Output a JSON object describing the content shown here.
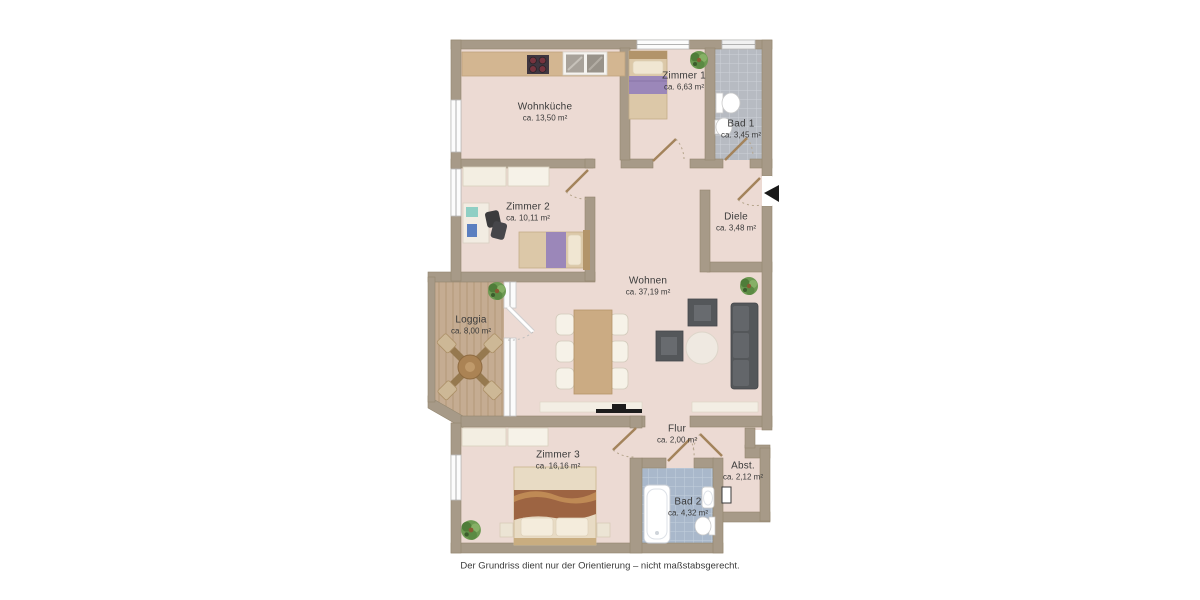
{
  "page": {
    "background": "#ffffff",
    "caption": "Der Grundriss dient nur der Orientierung – nicht maßstabsgerecht."
  },
  "rooms": [
    {
      "id": "wohnkueche",
      "name": "Wohnküche",
      "area": "ca. 13,50 m²"
    },
    {
      "id": "zimmer1",
      "name": "Zimmer 1",
      "area": "ca. 6,63 m²"
    },
    {
      "id": "bad1",
      "name": "Bad 1",
      "area": "ca. 3,45 m²"
    },
    {
      "id": "zimmer2",
      "name": "Zimmer 2",
      "area": "ca. 10,11 m²"
    },
    {
      "id": "diele",
      "name": "Diele",
      "area": "ca. 3,48 m²"
    },
    {
      "id": "wohnen",
      "name": "Wohnen",
      "area": "ca. 37,19 m²"
    },
    {
      "id": "loggia",
      "name": "Loggia",
      "area": "ca. 8,00 m²"
    },
    {
      "id": "zimmer3",
      "name": "Zimmer 3",
      "area": "ca. 16,16 m²"
    },
    {
      "id": "flur",
      "name": "Flur",
      "area": "ca. 2,00 m²"
    },
    {
      "id": "abst",
      "name": "Abst.",
      "area": "ca. 2,12 m²"
    },
    {
      "id": "bad2",
      "name": "Bad 2",
      "area": "ca. 4,32 m²"
    }
  ],
  "colors": {
    "wall": "#a79a88",
    "floor": "#ecdad3",
    "deck": "#c5ac92",
    "tile_gray": "#b7bbc2",
    "tile_blue": "#a9b8cb",
    "door_leaf": "#a3835b",
    "accent_purple": "#9b87b9",
    "furniture_dark": "#54575a",
    "wood": "#cbab83",
    "cream": "#f3eee4"
  },
  "icons": [
    "entrance-arrow-icon",
    "plant-icon",
    "stove-icon",
    "kitchen-sink-icon",
    "bathtub-icon",
    "toilet-icon",
    "washbasin-icon",
    "bed-icon",
    "sofa-icon",
    "armchair-icon",
    "dining-table-icon",
    "tv-icon",
    "door-swing-icon",
    "window-icon"
  ]
}
